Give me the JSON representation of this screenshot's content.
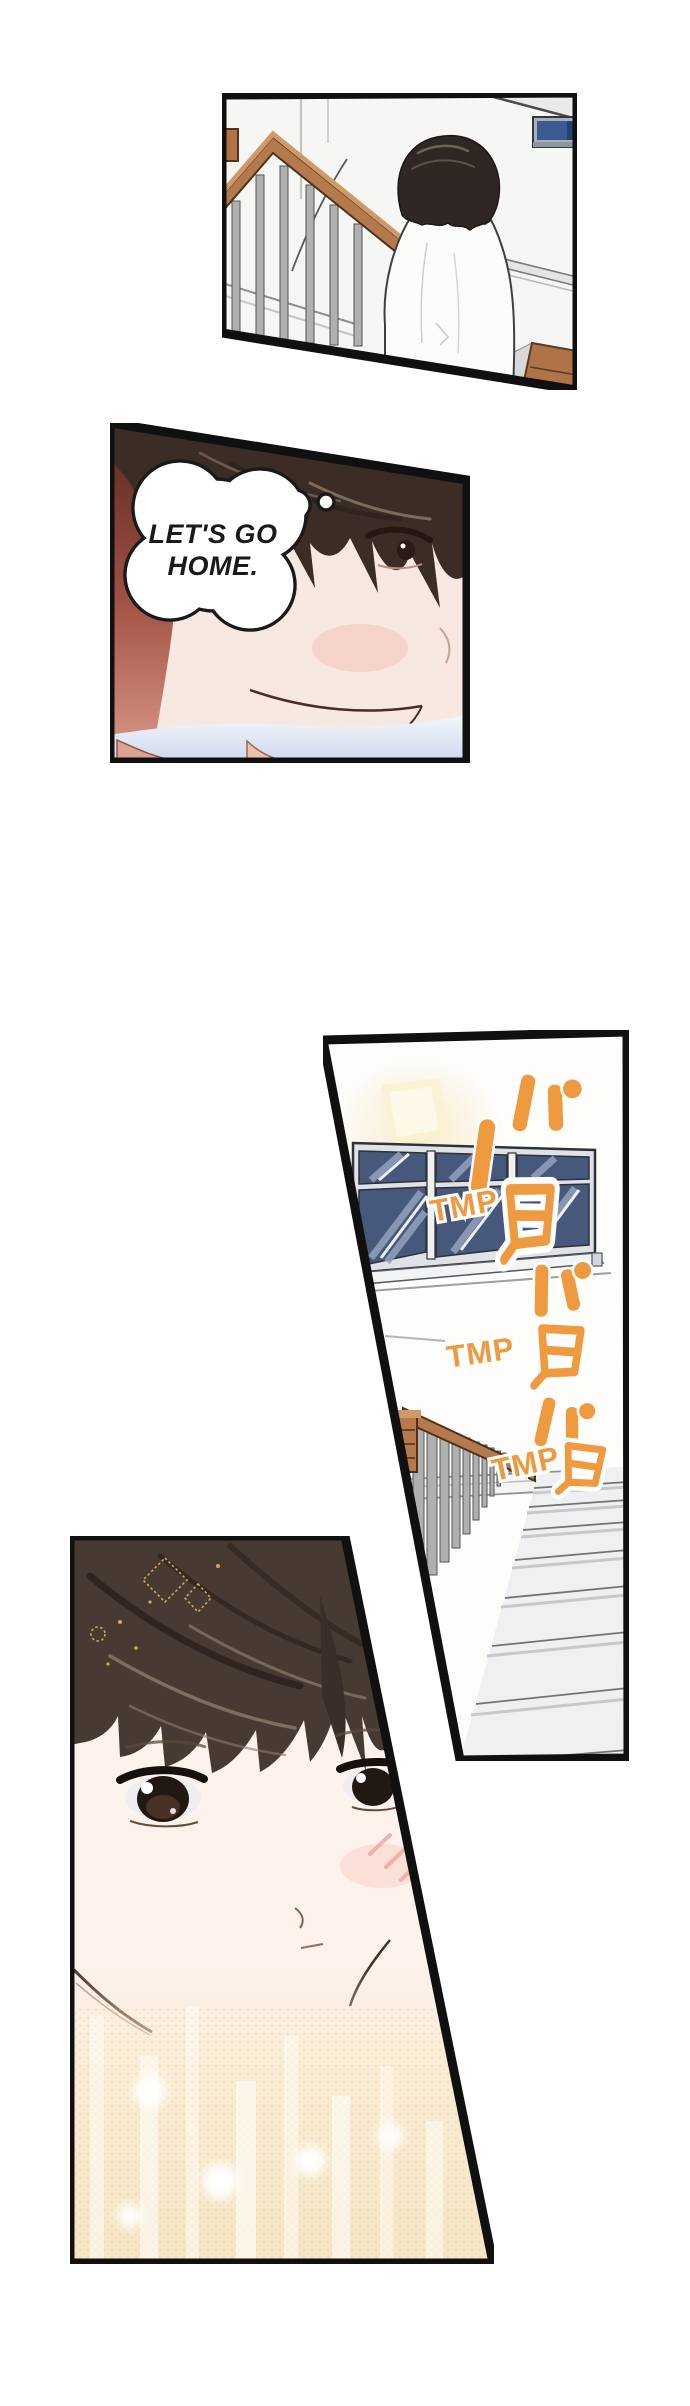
{
  "page": {
    "background": "#ffffff"
  },
  "palette": {
    "page-bg": "#ffffff",
    "panel-border": "#101010",
    "sfx-orange": "#f09a40",
    "text-black": "#1a1a1a",
    "wood-brown": "#b5794e",
    "wood-dark": "#4f3118",
    "window-glass": "#46587b",
    "sign-blue": "#3a5a94",
    "shading-red": "#a05043",
    "gold-glow": "#f7e8cb"
  },
  "panel2": {
    "thought_bubble": {
      "line1": "LET'S GO",
      "line2": "HOME."
    }
  },
  "panel3": {
    "sfx": {
      "tmp": [
        "TMP",
        "TMP",
        "TMP"
      ],
      "kana": [
        "パ",
        "タ",
        "パ",
        "タ",
        "パ",
        "タ"
      ]
    }
  }
}
